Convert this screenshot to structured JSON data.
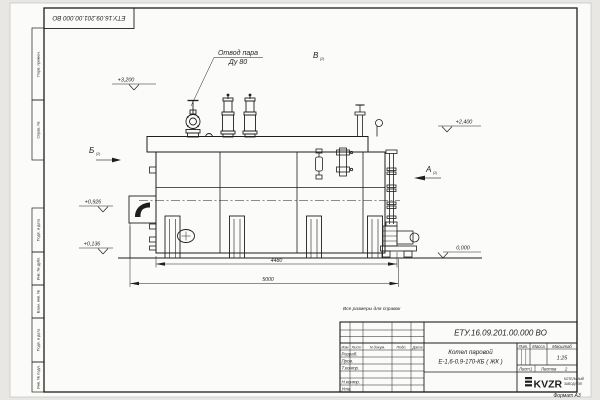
{
  "colors": {
    "paper": "#fbfbf9",
    "outside": "#e8e7e4",
    "ink": "#1e1e1c"
  },
  "corner_stamp": {
    "doc_number": "ЕТУ.16.09.201.00.000 ВО"
  },
  "margin": {
    "perv": "Перв. примен.",
    "sprav": "Справ. №",
    "podp_data_1": "Подп. и дата",
    "inv_dubl": "Инв. № дубл.",
    "vzam_inv": "Взам. инв. №",
    "podp_data_2": "Подп. и дата",
    "inv_podl": "Инв. № подл."
  },
  "drawing": {
    "steam_label_line1": "Отвод пара",
    "steam_label_line2": "Ду 80",
    "view_a": "А",
    "view_b": "Б",
    "view_v": "В",
    "view_sheet_ref": "(2)",
    "elev_3200": "+3,200",
    "elev_2400": "+2,400",
    "elev_0926": "+0,926",
    "elev_0136": "+0,136",
    "elev_0000": "0,000",
    "dim_4480": "4480",
    "dim_5000": "5000",
    "note": "Все размеры для справок"
  },
  "title_block": {
    "doc_number": "ЕТУ.16.09.201.00.000  ВО",
    "name_line1": "Котел паровой",
    "name_line2": "Е-1,6-0,9-170-КБ ( ЖК )",
    "hdr_izm": "Изм",
    "hdr_list": "Лист",
    "hdr_ndoc": "N докум.",
    "hdr_podp": "Подп.",
    "hdr_data": "Дата",
    "row_razrab": "Разраб.",
    "row_prov": "Пров.",
    "row_tkontr": "Т.контр.",
    "row_nkontr": "Н.контр.",
    "row_utv": "Утв.",
    "hdr_lit": "Лит.",
    "hdr_massa": "Масса",
    "hdr_masshtab": "Масштаб",
    "scale": "1:25",
    "sheet_label": "Лист",
    "sheet_value": "1",
    "sheets_label": "Листов",
    "sheets_value": "2",
    "logo_text": "KVZR",
    "logo_sub1": "КОТЕЛЬНЫЙ",
    "logo_sub2": "ЗАВОД РЭП",
    "format_label": "Формат А3"
  }
}
